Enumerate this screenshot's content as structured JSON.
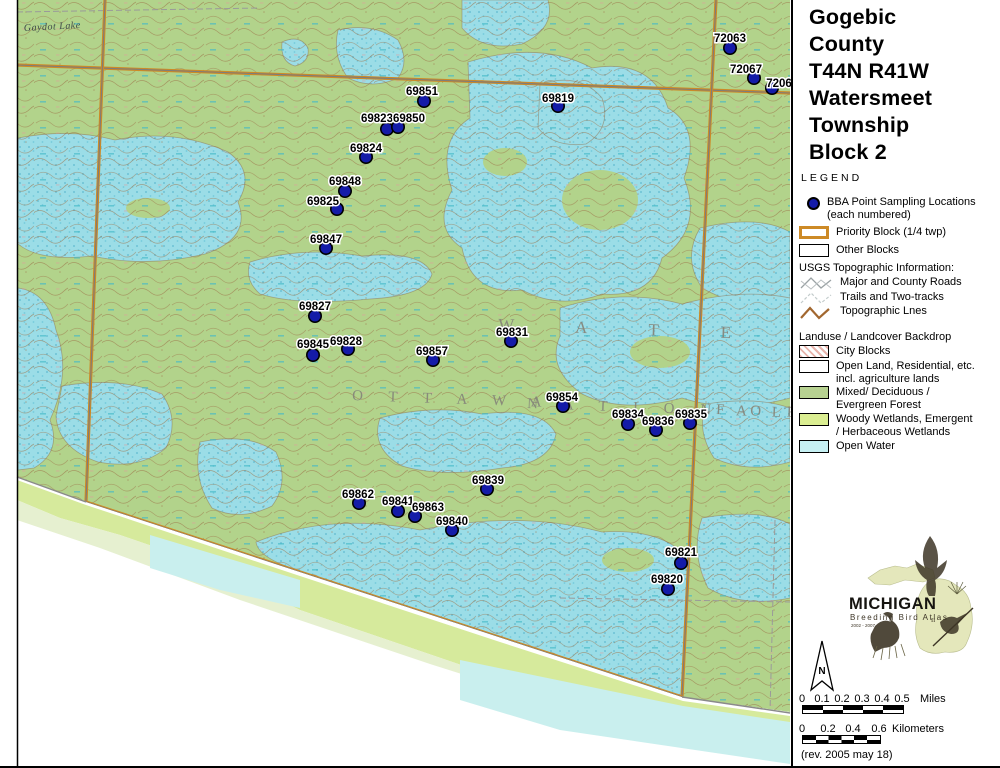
{
  "colors": {
    "block_orange": "#cd8a26",
    "sampling_dot_blue": "#141ba8",
    "forest_green": "#b2d38b",
    "open_water_cyan": "#9bdde7",
    "woody_wetland_green": "#dbee92",
    "legend_water_swatch": "#c6f0f3"
  },
  "legend": {
    "title_lines": [
      "Gogebic",
      "County",
      "T44N R41W",
      "Watersmeet",
      "Township",
      "Block 2"
    ],
    "legend_heading": "LEGEND",
    "bba_label_1": "BBA Point Sampling Locations",
    "bba_label_2": "(each numbered)",
    "priority_label": "Priority Block (1/4 twp)",
    "other_label": "Other Blocks",
    "usgs_heading": "USGS Topographic Information:",
    "roads_label": "Major and County Roads",
    "trails_label": "Trails and Two-tracks",
    "topo_label": "Topographic Lnes",
    "landuse_heading": "Landuse / Landcover Backdrop",
    "city_label": "City Blocks",
    "openland_label_1": "Open Land, Residential, etc.",
    "openland_label_2": "incl. agriculture lands",
    "mixed_label_1": "Mixed/ Deciduous /",
    "mixed_label_2": "Evergreen Forest",
    "woody_label_1": "Woody Wetlands, Emergent",
    "woody_label_2": "/ Herbaceous Wetlands",
    "water_label": "Open Water"
  },
  "map": {
    "points": [
      {
        "id": "69851",
        "x": 424,
        "y": 101,
        "lx": 422,
        "ly": 91
      },
      {
        "id": "69819",
        "x": 558,
        "y": 106,
        "lx": 558,
        "ly": 98
      },
      {
        "id": "72063",
        "x": 730,
        "y": 48,
        "lx": 730,
        "ly": 38
      },
      {
        "id": "72067",
        "x": 754,
        "y": 78,
        "lx": 746,
        "ly": 69
      },
      {
        "id": "7206",
        "x": 772,
        "y": 88,
        "lx": 779,
        "ly": 83
      },
      {
        "id": "69823",
        "x": 387,
        "y": 129,
        "lx": 377,
        "ly": 118
      },
      {
        "id": "69850",
        "x": 398,
        "y": 127,
        "lx": 409,
        "ly": 118
      },
      {
        "id": "69824",
        "x": 366,
        "y": 157,
        "lx": 366,
        "ly": 148
      },
      {
        "id": "69848",
        "x": 345,
        "y": 191,
        "lx": 345,
        "ly": 181
      },
      {
        "id": "69825",
        "x": 337,
        "y": 209,
        "lx": 323,
        "ly": 201
      },
      {
        "id": "69847",
        "x": 326,
        "y": 248,
        "lx": 326,
        "ly": 239
      },
      {
        "id": "69827",
        "x": 315,
        "y": 316,
        "lx": 315,
        "ly": 306
      },
      {
        "id": "69845",
        "x": 313,
        "y": 355,
        "lx": 313,
        "ly": 344
      },
      {
        "id": "69828",
        "x": 348,
        "y": 349,
        "lx": 346,
        "ly": 341
      },
      {
        "id": "69857",
        "x": 433,
        "y": 360,
        "lx": 432,
        "ly": 351
      },
      {
        "id": "69831",
        "x": 511,
        "y": 341,
        "lx": 512,
        "ly": 332
      },
      {
        "id": "69854",
        "x": 563,
        "y": 406,
        "lx": 562,
        "ly": 397
      },
      {
        "id": "69834",
        "x": 628,
        "y": 424,
        "lx": 628,
        "ly": 414
      },
      {
        "id": "69836",
        "x": 656,
        "y": 430,
        "lx": 658,
        "ly": 421
      },
      {
        "id": "69835",
        "x": 690,
        "y": 423,
        "lx": 691,
        "ly": 414
      },
      {
        "id": "69839",
        "x": 487,
        "y": 489,
        "lx": 488,
        "ly": 480
      },
      {
        "id": "69862",
        "x": 359,
        "y": 503,
        "lx": 358,
        "ly": 494
      },
      {
        "id": "69841",
        "x": 398,
        "y": 511,
        "lx": 398,
        "ly": 501
      },
      {
        "id": "69863",
        "x": 415,
        "y": 516,
        "lx": 428,
        "ly": 507
      },
      {
        "id": "69840",
        "x": 452,
        "y": 530,
        "lx": 452,
        "ly": 521
      },
      {
        "id": "69821",
        "x": 681,
        "y": 563,
        "lx": 681,
        "ly": 552
      },
      {
        "id": "69820",
        "x": 668,
        "y": 589,
        "lx": 667,
        "ly": 579
      }
    ],
    "area_labels": [
      {
        "name": "township-name-letters",
        "text": "W A T E R S M",
        "x": 498,
        "y": 330,
        "cls": "big-letters-xl",
        "rot": 2
      },
      {
        "name": "forest-name-letters",
        "text": "O T T A W A",
        "x": 352,
        "y": 400,
        "cls": "big-letters",
        "rot": 2
      },
      {
        "name": "forest-name-letters",
        "text": "N A T I O N A L",
        "x": 527,
        "y": 408,
        "cls": "big-letters",
        "rot": 2
      },
      {
        "name": "forest-name-letters",
        "text": "F O R",
        "x": 716,
        "y": 414,
        "cls": "big-letters",
        "rot": 2
      },
      {
        "name": "lake-name-label",
        "text": "Gaydot Lake",
        "x": 24,
        "y": 31,
        "cls": "lake-label",
        "rot": -3
      }
    ]
  },
  "logo": {
    "name": "MICHIGAN",
    "subtitle": "Breeding Bird Atlas",
    "years": "2002 - 2007",
    "numeral": "II"
  },
  "north_label": "N",
  "scale": {
    "miles_ticks": [
      "0",
      "0.1",
      "0.2",
      "0.3",
      "0.4",
      "0.5"
    ],
    "miles_unit": "Miles",
    "km_ticks": [
      "0",
      "0.2",
      "0.4",
      "0.6"
    ],
    "km_unit": "Kilometers"
  },
  "rev_note": "(rev. 2005 may 18)"
}
